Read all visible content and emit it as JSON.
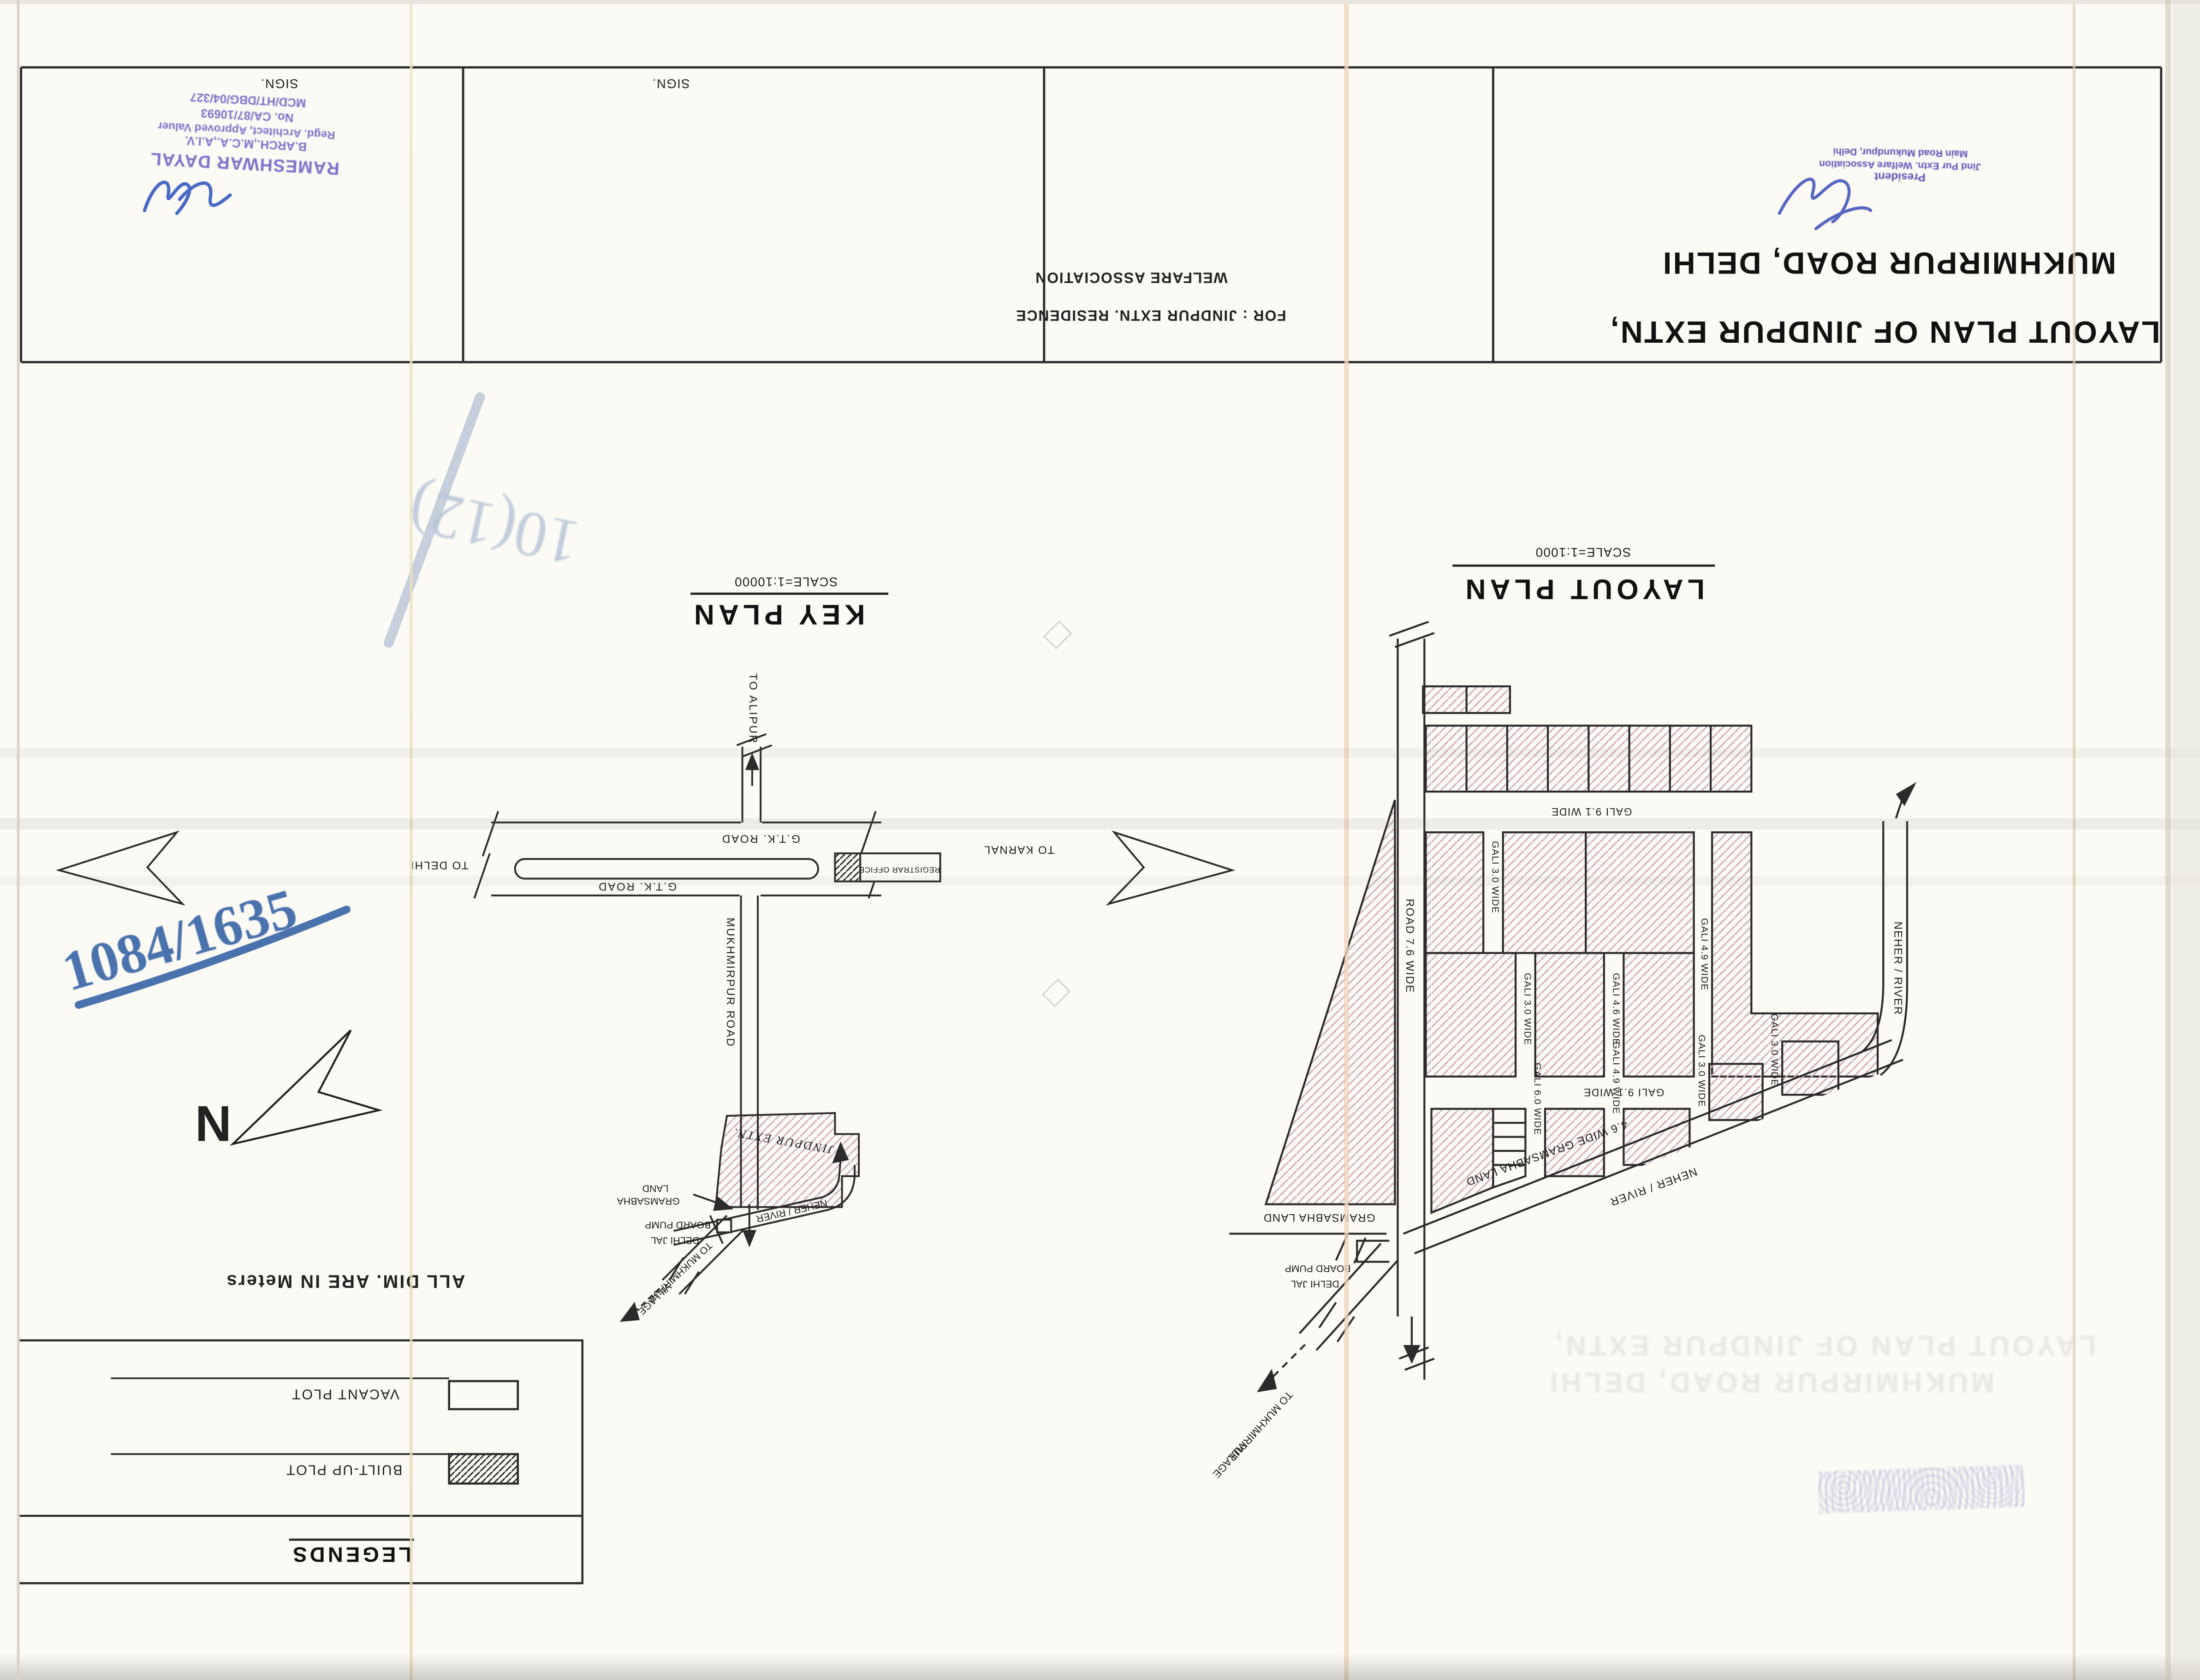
{
  "document": {
    "title_line1": "LAYOUT PLAN OF JINDPUR EXTN,",
    "title_line2": "MUKHMIRPUR ROAD,  DELHI",
    "for_line1": "FOR :  JINDPUR EXTN.  RESIDENCE",
    "for_line2": "WELFARE  ASSOCIATION",
    "sign_label_1": "SIGN.",
    "sign_label_2": "SIGN."
  },
  "stamps": {
    "architect": {
      "line1": "RAMESHWAR DAYAL",
      "line2": "B.ARCH.,M.C.A.,A.I.V.",
      "line3": "Regd. Architect, Approved Valuer",
      "line4": "No. CA/87/10693",
      "line5": "MCD/HT/DBG/04/327"
    },
    "president": {
      "line1": "President",
      "line2": "Jind Pur Extn. Welfare Association",
      "line3": "Main Road Mukundpur, Delhi"
    }
  },
  "annotations": {
    "blue_marker": "1084/1635",
    "faded_blue": "10(12)",
    "north_letter": "N",
    "all_dim": "ALL DIM. ARE IN Meters",
    "ghost_line1": "LAYOUT PLAN OF JINDPUR EXTN,",
    "ghost_line2": "MUKHMIRPUR ROAD,  DELHI"
  },
  "legends": {
    "title": "LEGENDS",
    "vacant": "VACANT PLOT",
    "built": "BUILT-UP PLOT"
  },
  "layout_plan": {
    "heading": "LAYOUT PLAN",
    "scale": "SCALE=1:1000",
    "road": "ROAD 7.6 WIDE",
    "gali_91_a": "GALI 9.1 WIDE",
    "gali_91_b": "GALI 9.1 WIDE",
    "gali_30_a": "GALI 3.0 WIDE",
    "gali_30_b": "GALI 3.0 WIDE",
    "gali_30_c": "GALI 3.0 WIDE",
    "gali_30_d": "GALI 3.0 WIDE",
    "gali_49_a": "GALI 4.9 WIDE",
    "gali_49_b": "GALI 4.9 WIDE",
    "gali_46": "GALI 4.6 WIDE",
    "gali_60": "GALI 6.0 WIDE",
    "neher_vert": "NEHER / RIVER",
    "neher_diag": "NEHER / RIVER",
    "gramsabha_diag": "4.6 WIDE GRAMSABHA LAND",
    "gramsabha": "GRAMSABHA LAND",
    "pump_line1": "DELHI JAL",
    "pump_line2": "BOARD PUMP",
    "village_line1": "TO MUKHMIRPUR",
    "village_line2": "VILLAGE"
  },
  "key_plan": {
    "heading": "KEY PLAN",
    "scale": "SCALE=1:10000",
    "to_alipur": "TO ALIPUR",
    "to_delhi": "TO DELHI",
    "to_karnal": "TO KARNAL",
    "gtk_top": "G.T.K. ROAD",
    "gtk_bottom": "G.T.K. ROAD",
    "registrar": "REGISTRAR OFFICE",
    "mukhmirpur_road": "MUKHMIRPUR ROAD",
    "jindpur": "JINDPUR EXTN.",
    "gramsabha_line1": "LAND",
    "gramsabha_line2": "GRAMSABHA",
    "pump_line1": "BOARD PUMP",
    "pump_line2": "DELHI JAL",
    "neher": "NEHER / RIVER",
    "village_line1": "TO MUKHMIRPUR",
    "village_line2": "VILLAGE"
  }
}
